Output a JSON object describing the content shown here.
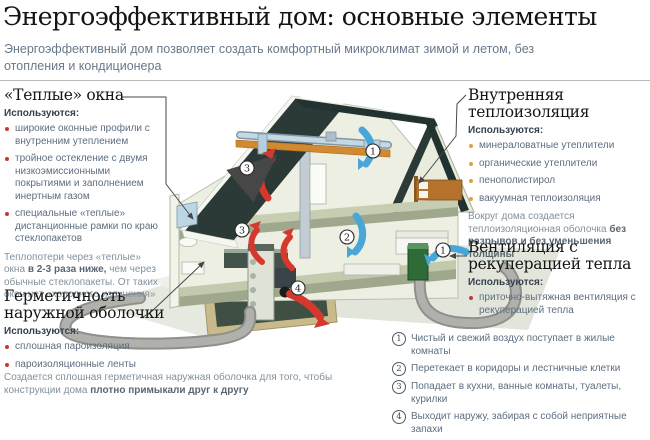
{
  "header": {
    "title": "Энергоэффективный дом: основные элементы",
    "subtitle": "Энергоэффективный дом позволяет создать комфортный микроклимат зимой и летом, без отопления и кондиционера"
  },
  "sections": {
    "warm_windows": {
      "title": "«Теплые» окна",
      "uses_label": "Используются:",
      "bullets": [
        "широкие оконные профили с внутренним утеплением",
        "тройное остекление с двумя низкоэмиссионными покрытиями и заполнением инертным газом",
        "специальные «теплые» дистанционные рамки по краю стеклопакетов"
      ],
      "note": {
        "prefix": "Теплопотери через «теплые» окна ",
        "bold": "в 2-3 раза ниже,",
        "suffix": " чем через обычные стеклопакеты. От таких окон нет «холодного излучения»"
      }
    },
    "sealing": {
      "title": "Герметичность наружной оболочки",
      "uses_label": "Используются:",
      "bullets": [
        "сплошная пароизоляция",
        "пароизоляционные ленты"
      ],
      "note": {
        "prefix": "Создается сплошная герметичная наружная оболочка для того, чтобы конструкции дома ",
        "bold": "плотно примыкали друг к другу",
        "suffix": ""
      }
    },
    "insulation": {
      "title": "Внутренняя теплоизоляция",
      "uses_label": "Используются:",
      "bullets": [
        "минераловатные утеплители",
        "органические утеплители",
        "пенополистирол",
        "вакуумная теплоизоляция"
      ],
      "note": {
        "prefix": "Вокруг дома создается теплоизоляционная оболочка ",
        "bold": "без разрывов и без уменьшения толщины",
        "suffix": ""
      }
    },
    "ventilation": {
      "title": "Вентиляция с рекуперацией тепла",
      "uses_label": "Используются:",
      "bullets": [
        "приточно-вытяжная вентиляция с рекуперацией тепла"
      ]
    }
  },
  "airflow_steps": [
    {
      "num": "1",
      "text": "Чистый и свежий воздух поступает в жилые комнаты"
    },
    {
      "num": "2",
      "text": "Перетекает в коридоры и лестничные клетки"
    },
    {
      "num": "3",
      "text": "Попадает в кухни, ванные комнаты, туалеты, курилки"
    },
    {
      "num": "4",
      "text": "Выходит наружу, забирая с собой неприятные запахи"
    }
  ],
  "diagram": {
    "markers": {
      "attic_exhaust": "3",
      "attic_supply": "1",
      "floor_exhaust": "3",
      "floor_supply": "2",
      "basement_out": "4",
      "intake": "1"
    }
  },
  "colors": {
    "accent_red": "#c23b33",
    "accent_orange": "#e2a23b",
    "roof": "#2b3a36",
    "insulation_strip": "#d28a30",
    "arrow_red": "#d6382e",
    "arrow_blue": "#49a7d8",
    "text_gray_blue": "#5d6e80"
  }
}
